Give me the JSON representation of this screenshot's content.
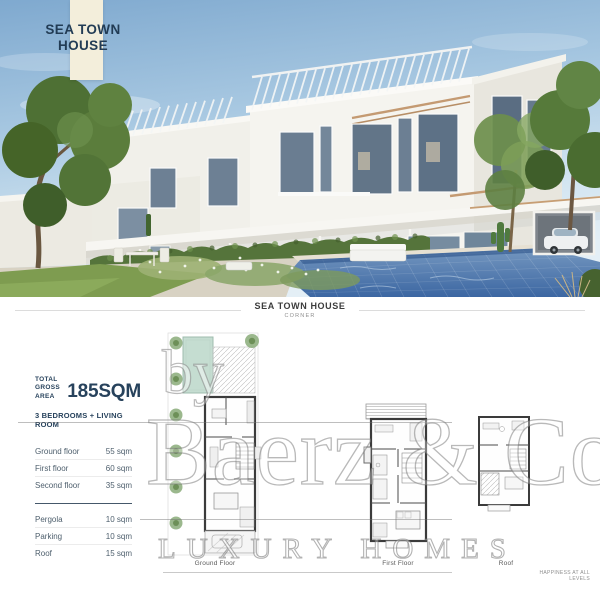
{
  "banner": {
    "line1": "SEA TOWN",
    "line2": "HOUSE"
  },
  "heading": {
    "title": "SEA TOWN HOUSE",
    "subtitle": "CORNER"
  },
  "specs": {
    "total_label_top": "TOTAL",
    "total_label_bottom": "GROSS AREA",
    "total_value": "185SQM",
    "configuration": "3 BEDROOMS + LIVING ROOM",
    "floors": [
      {
        "label": "Ground floor",
        "value": "55 sqm"
      },
      {
        "label": "First floor",
        "value": "60 sqm"
      },
      {
        "label": "Second floor",
        "value": "35 sqm"
      }
    ],
    "extras": [
      {
        "label": "Pergola",
        "value": "10 sqm"
      },
      {
        "label": "Parking",
        "value": "10 sqm"
      },
      {
        "label": "Roof",
        "value": "15 sqm"
      }
    ]
  },
  "plans": {
    "ground": {
      "label": "Ground Floor"
    },
    "first": {
      "label": "First Floor"
    },
    "roof": {
      "label": "Roof"
    }
  },
  "watermark": {
    "prefix": "by",
    "brand": "Baerz & Co",
    "tagline": "LUXURY HOMES"
  },
  "footer": {
    "slogan": "HAPPINESS AT ALL LEVELS"
  },
  "colors": {
    "accent_navy": "#27425c",
    "banner_cream": "#f3eedb",
    "pool_blue": "#3c67a2",
    "plan_pool_teal": "#c5ddd1",
    "greenery": "#55743b"
  }
}
